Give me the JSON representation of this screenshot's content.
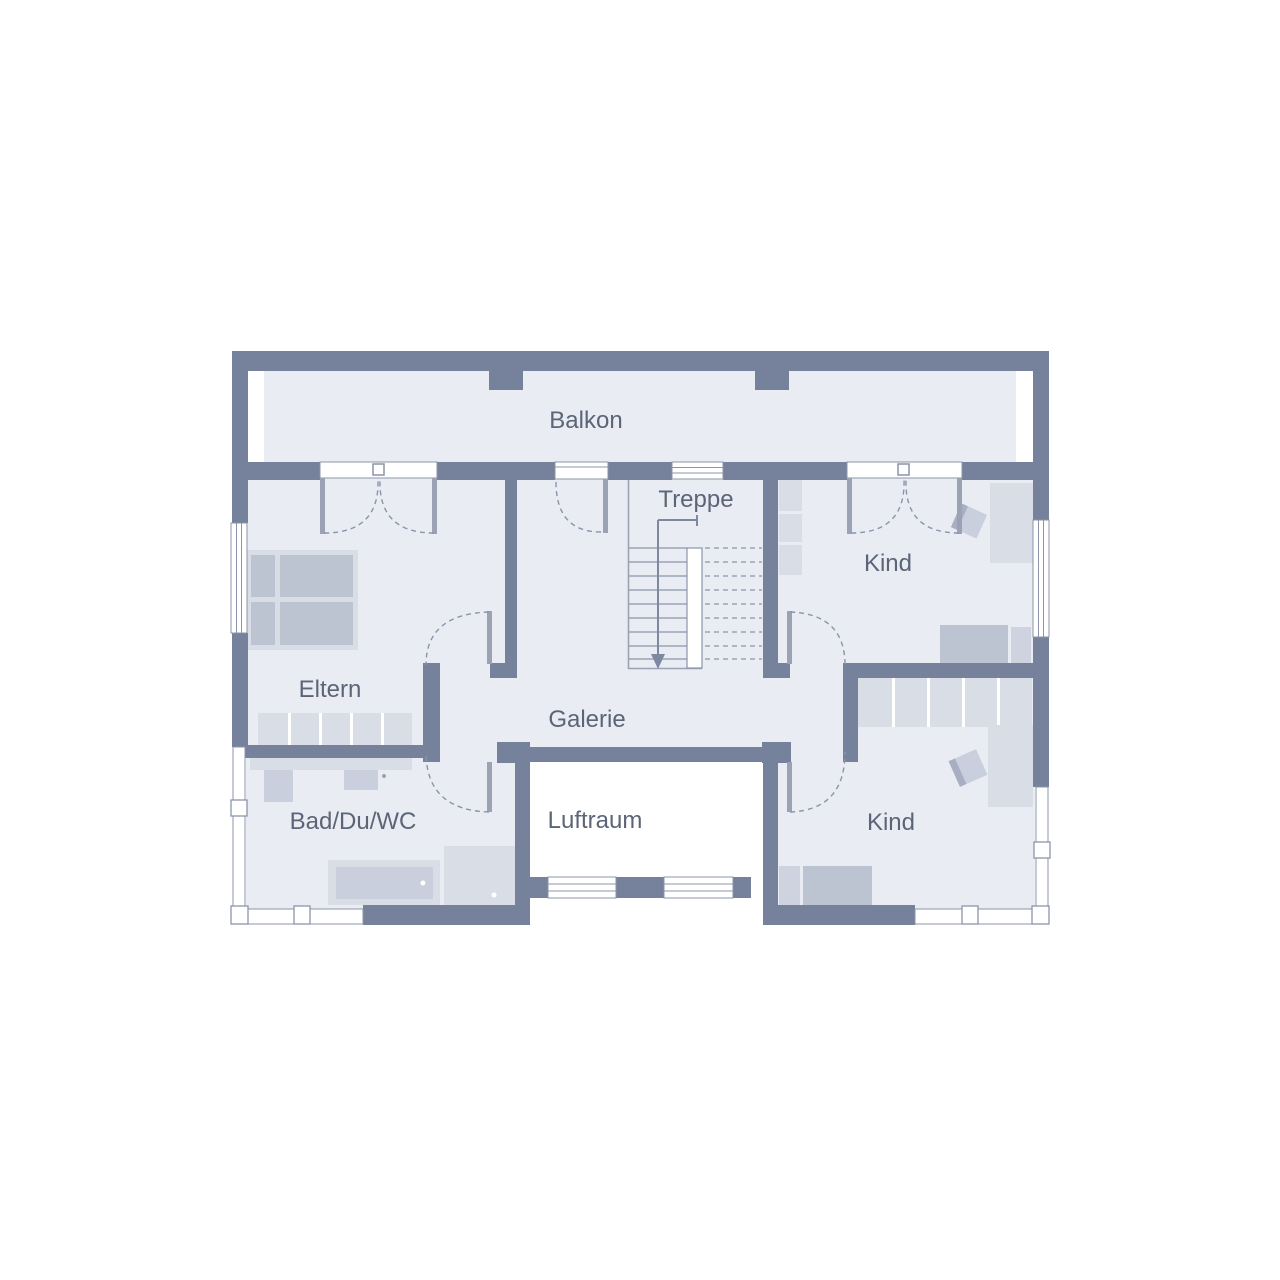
{
  "floorplan": {
    "rooms": {
      "balkon": {
        "label": "Balkon"
      },
      "treppe": {
        "label": "Treppe"
      },
      "kind_top": {
        "label": "Kind"
      },
      "eltern": {
        "label": "Eltern"
      },
      "galerie": {
        "label": "Galerie"
      },
      "bad": {
        "label": "Bad/Du/WC"
      },
      "luftraum": {
        "label": "Luftraum"
      },
      "kind_bottom": {
        "label": "Kind"
      }
    },
    "colors": {
      "wall": "#76829B",
      "floor": "#E9ECF3",
      "line": "#8B94A9",
      "leaf": "#9AA2B4",
      "arrow": "#7E88A0",
      "text": "#5C6577",
      "furniture": "#D9DDE6",
      "furniture_mid": "#C9CFDC",
      "bed": "#BCC3D1",
      "pillow": "#CED3DF",
      "chair_back": "#A8AFC2",
      "background": "#FFFFFF"
    }
  }
}
